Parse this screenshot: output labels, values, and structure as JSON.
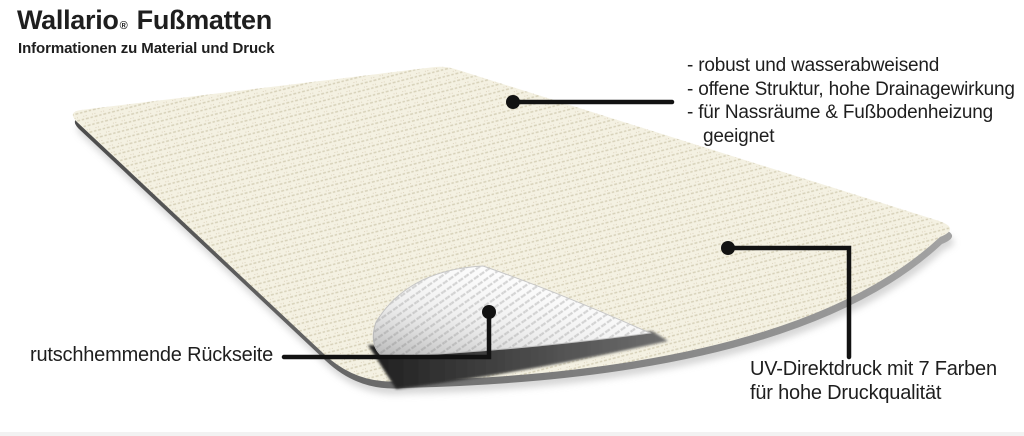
{
  "header": {
    "brand": "Wallario",
    "registered_mark": "®",
    "product": "Fußmatten",
    "subtitle": "Informationen zu Material und Druck"
  },
  "annotations": {
    "features": [
      "- robust und wasserabweisend",
      "- offene Struktur, hohe Drainagewirkung",
      "- für Nassräume & Fußbodenheizung geeignet"
    ],
    "backside_label": "rutschhemmende Rückseite",
    "print_label_line1": "UV-Direktdruck mit 7 Farben",
    "print_label_line2": "für hohe Druckqualität"
  },
  "colors": {
    "background": "#ffffff",
    "mat": "#f4f1e2",
    "mat_line": "#d7d1b9",
    "mat_speck": "#cbbda2",
    "fold": "#fdfdfd",
    "fold_rib": "#d2d2d2",
    "callout": "#121212",
    "text": "#1e1e1e",
    "strip": "#f2f2f2"
  }
}
